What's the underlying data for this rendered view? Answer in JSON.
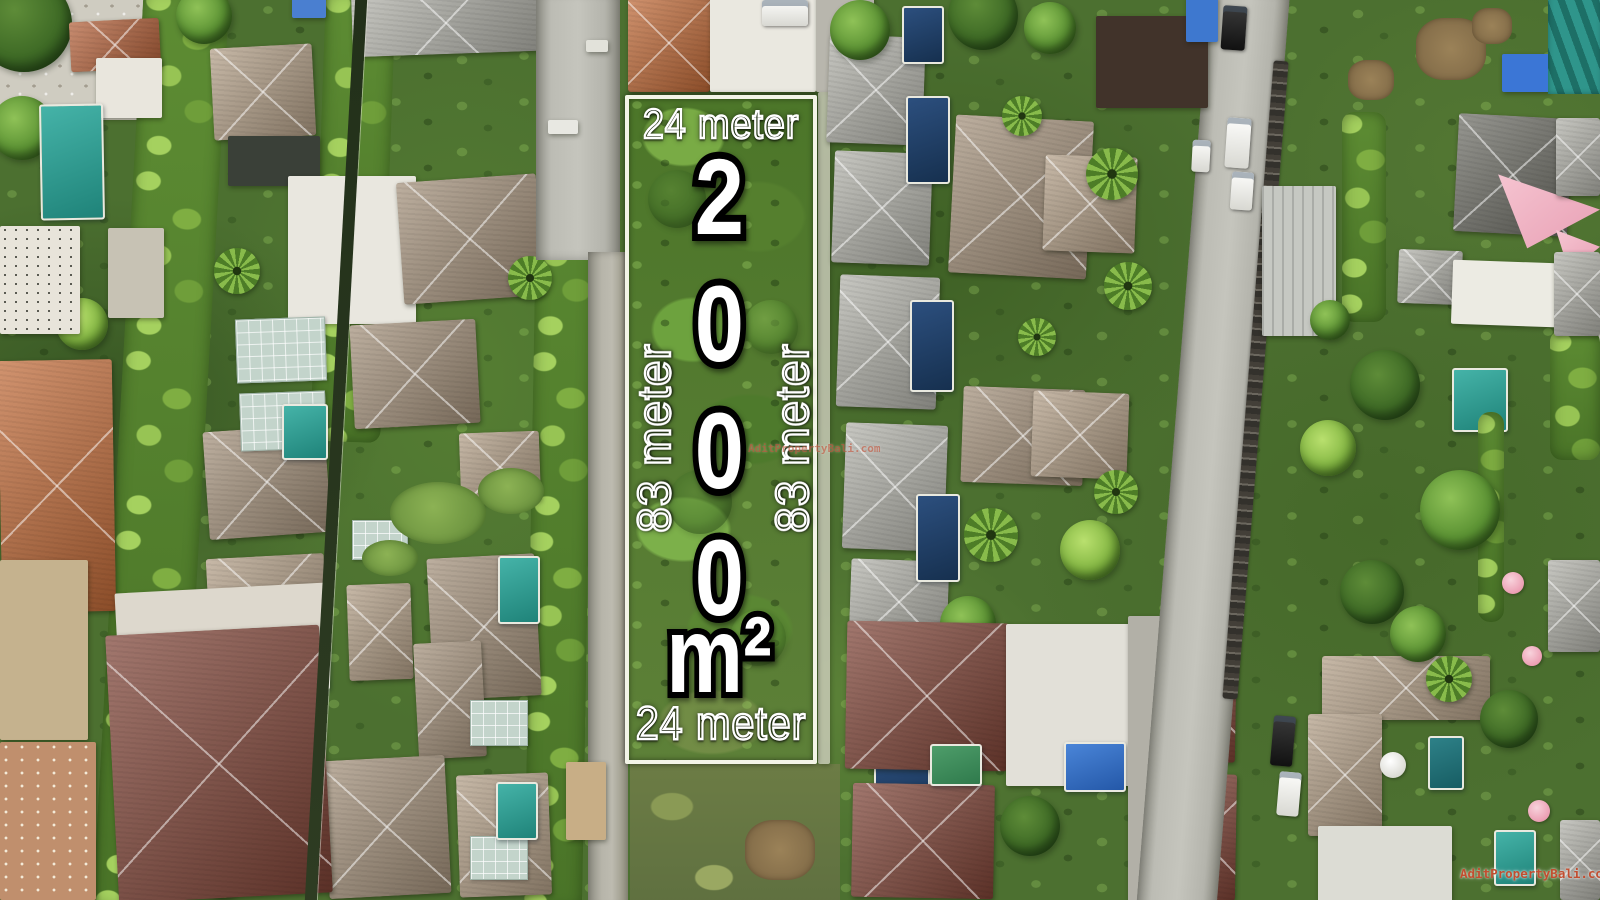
{
  "plot_overlay": {
    "top_width": "24 meter",
    "bottom_width": "24 meter",
    "left_length": "83 meter",
    "right_length": "83 meter",
    "area_value": "2000",
    "area_unit": "m²"
  },
  "watermarks": {
    "center": "AditPropertyBali.com",
    "bottom_right": "AditPropertyBali.com"
  },
  "colors": {
    "plot_border": "#f3f4e7",
    "overlay_text": "#ffffff",
    "digit_outline": "#000000",
    "watermark_red": "#c24e30"
  }
}
